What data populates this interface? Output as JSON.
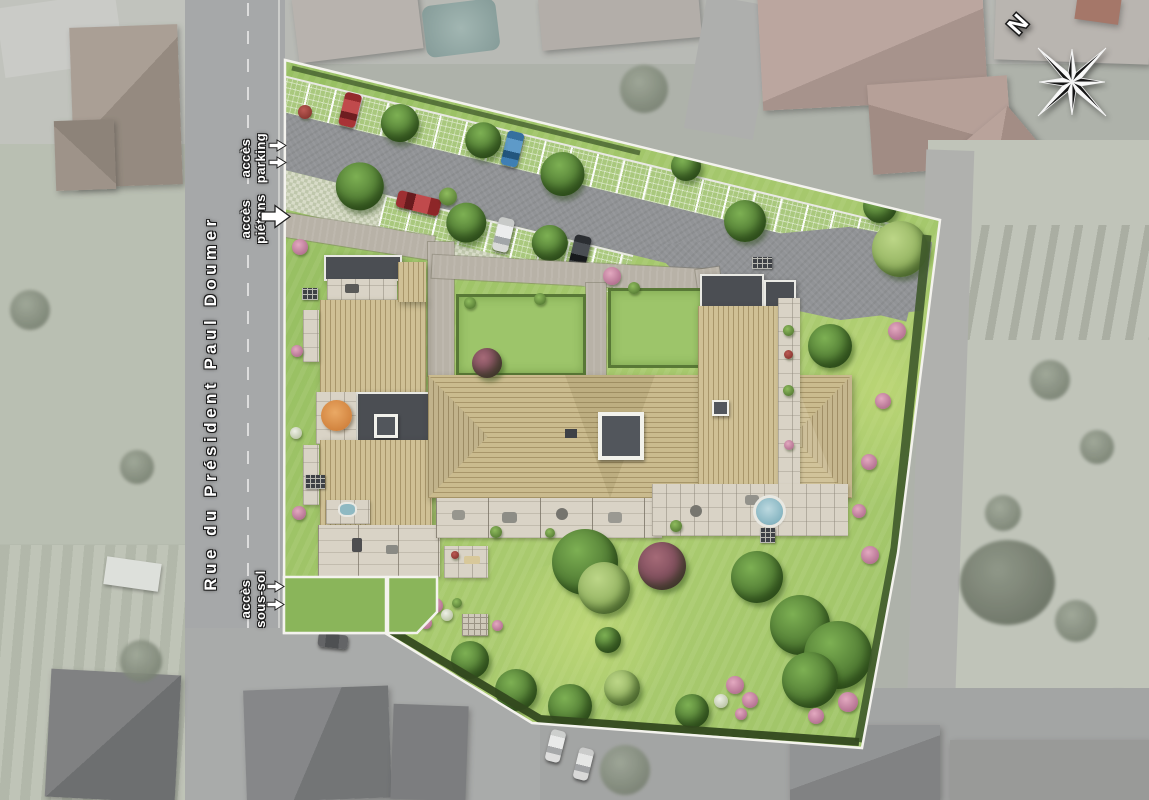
{
  "street": {
    "name": "Rue du Président Paul Doumer"
  },
  "access": {
    "parking": {
      "line1": "accès",
      "line2": "parking"
    },
    "pietons": {
      "line1": "accès",
      "line2": "piétons"
    },
    "soussol": {
      "line1": "accès",
      "line2": "sous-sol"
    }
  },
  "compass": {
    "north": "N"
  },
  "colors": {
    "site_lawn": "#98c063",
    "roof_wood": "#cfc095",
    "roof_flat": "#4b4e53",
    "boundary_line": "#f4f3ee",
    "hedge": "#3f5a2b",
    "asphalt": "#919396",
    "walkway": "#b8b2a7",
    "terrace": "#d9d3c6",
    "car_red": "#b23a3c",
    "car_blue": "#4b89bd",
    "car_white": "#e9eae8",
    "car_black": "#2f3236",
    "parasol_orange": "#df9550"
  }
}
